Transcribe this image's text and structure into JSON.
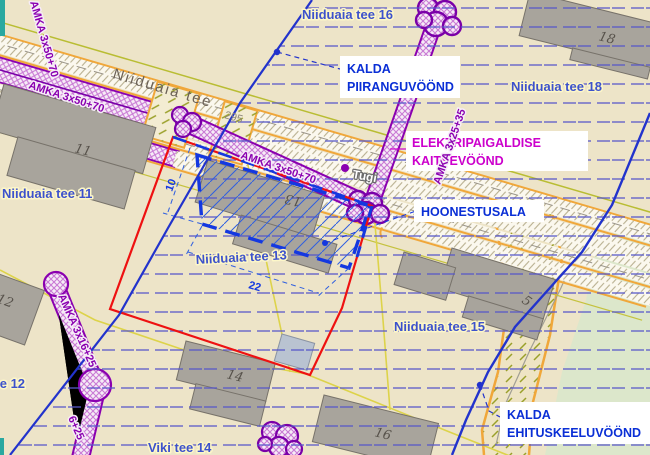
{
  "map": {
    "road_label": "Niiduaia tee",
    "road_number": "295",
    "support_label": "Tugi",
    "cables": {
      "c_road_1": "AMKA 3x50+70",
      "c_road_2": "AMKA 3x50+70",
      "c_edge": "AMKA 3x50+70",
      "c_north": "AMKA 3x25+35",
      "c_south": "AMKA 3x16+25",
      "c_south_tail": "6+25"
    },
    "plots": {
      "p11": "Niiduaia tee 11",
      "p12": "Niiduaia tee 12",
      "p13": "Niiduaia tee 13",
      "p15": "Niiduaia tee 15",
      "p16": "Niiduaia tee 16",
      "p18": "Niiduaia tee 18",
      "viki14": "Viki tee 14"
    },
    "building_numbers": {
      "b11": "11",
      "b12": "12",
      "b13": "13",
      "b14": "14",
      "b16": "16",
      "b18": "18",
      "b5": "5"
    },
    "dimensions": {
      "d10": "10",
      "d22": "22"
    },
    "annotations": {
      "kalda_piiranguvoond": [
        "KALDA",
        "PIIRANGUVÖÖND"
      ],
      "elektripaigaldise_kaitsevoond": [
        "ELEKTRIPAIGALDISE",
        "KAITSEVÖÖND"
      ],
      "hoonestusala": "HOONESTUSALA",
      "kalda_ehituskeeluvoond": [
        "KALDA",
        "EHITUSKEELUVÖÖND"
      ]
    },
    "colors": {
      "background": "#ede4c8",
      "planning_boundary_red": "#ee1111",
      "zone_line_blue": "#2233cc",
      "hoonestusala_blue": "#1438e0",
      "cable_purple": "#8a00b0",
      "elektri_magenta": "#cc00cc",
      "road_orange": "#f0a73a",
      "stripe_blue": "#5757c9",
      "cadastral_yellow": "#ddd34a",
      "building_gray": "#a8a49c",
      "green_area": "#dce7cb"
    }
  }
}
